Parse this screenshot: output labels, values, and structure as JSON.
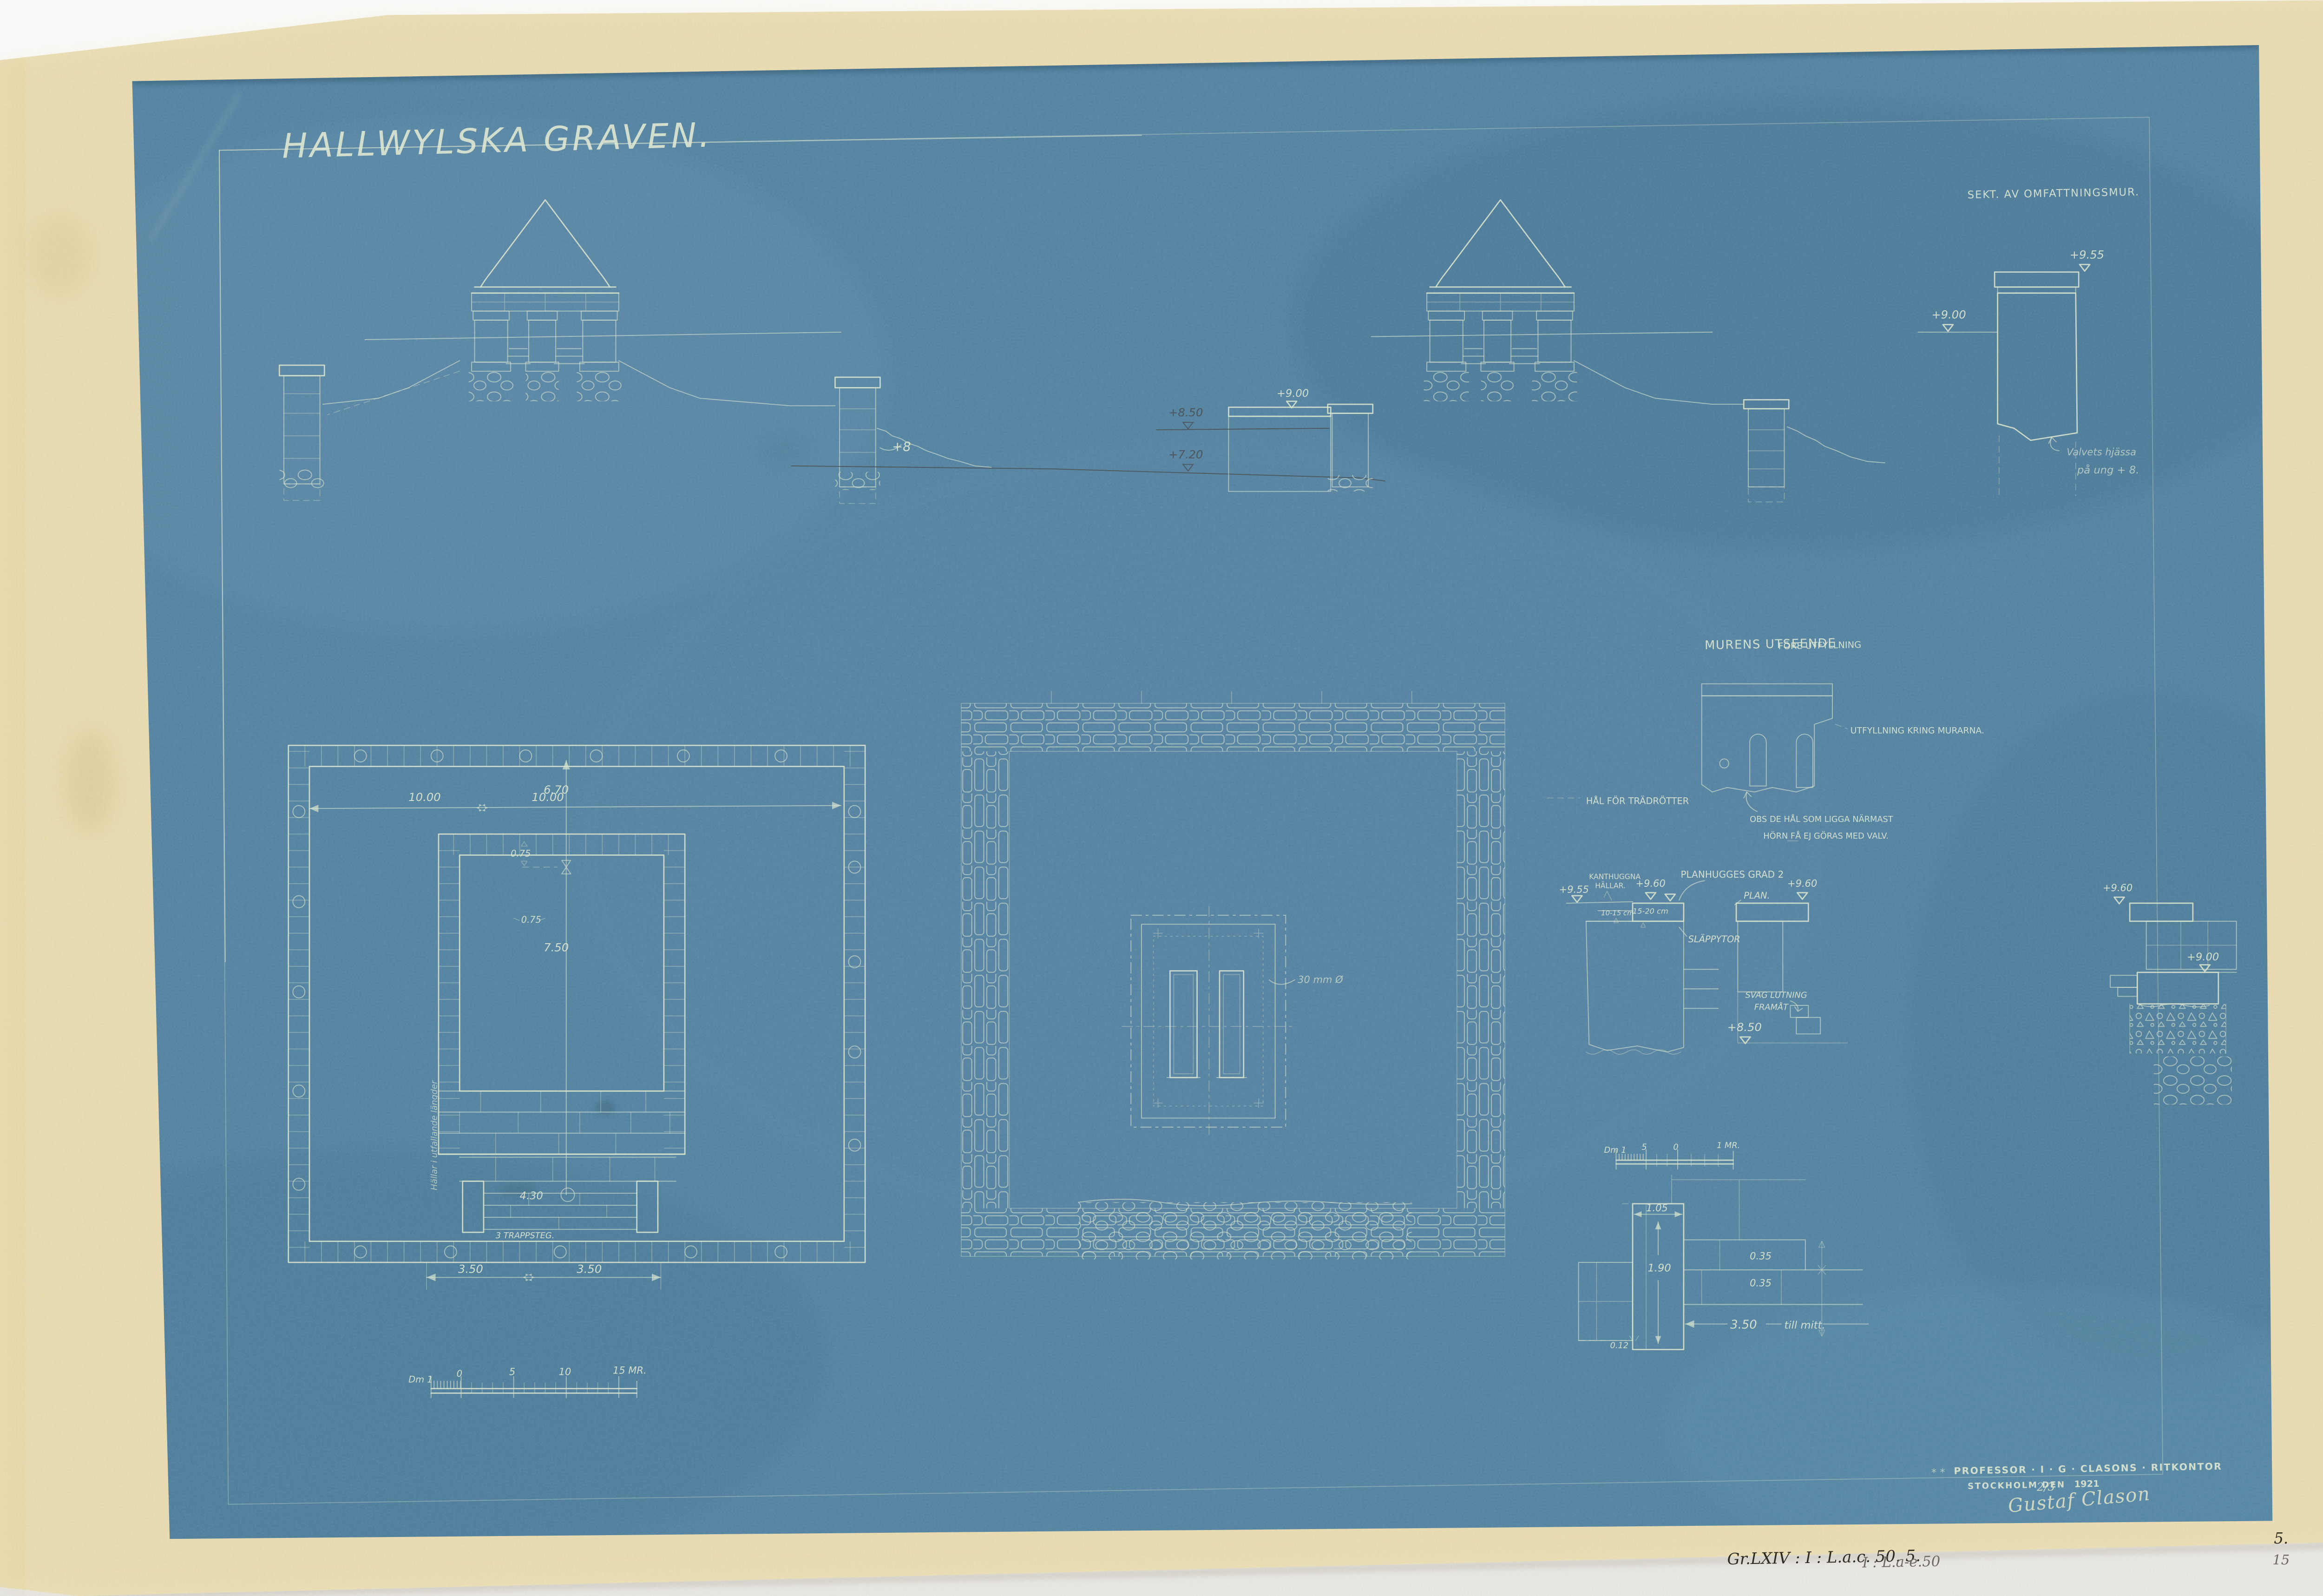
{
  "page": {
    "title": "HALLWYLSKA GRAVEN."
  },
  "margin": {
    "archive_ink": "Gr.LXIV : I : L.a.c. 50. 5.",
    "archive_pencil": "I : L.a-e.50",
    "sheet_ink": "5.",
    "sheet_pencil": "15",
    "stamp_marks": "* *"
  },
  "stamp": {
    "office": "PROFESSOR · I · G · CLASONS · RITKONTOR",
    "place": "STOCKHOLM DEN",
    "date": "2/3",
    "year": "1921",
    "signature": "Gustaf Clason"
  },
  "wall_section": {
    "title": "SEKT. AV OMFATTNINGSMUR.",
    "level_top": "+9.55",
    "level_mid": "+9.00",
    "note_line1": "Valvets hjässa",
    "note_line2": "på ung + 8."
  },
  "elevation_left": {
    "level_right": "+8"
  },
  "elevation_right": {
    "level_wall": "+9.00",
    "pencil_level_upper": "+8.50",
    "pencil_level_lower": "+7.20"
  },
  "plan_left": {
    "dim_width_a": "10.00",
    "dim_width_b": "10.00",
    "dim_a": "6.70",
    "dim_wall_a": "0.75",
    "dim_wall_b": "0.75",
    "dim_b": "7.50",
    "dim_c": "4.30",
    "steps_label": "3 TRAPPSTEG.",
    "dim_step_a": "3.50",
    "dim_step_b": "3.50",
    "wall_note": "Hällar i utfallande längder"
  },
  "plan_center": {
    "bore_note": "30 mm Ø"
  },
  "wall_study": {
    "title": "MURENS UTSEENDE",
    "subtitle": "FÖRE UTFYLLNING",
    "fill_label": "UTFYLLNING KRING MURARNA.",
    "holes_label": "HÅL FÖR TRÄDRÖTTER",
    "note_line1": "OBS DE HÅL SOM LIGGA NÄRMAST",
    "note_line2": "HÖRN FÅ EJ GÖRAS MED VALV."
  },
  "detail_slabs": {
    "level_a": "+9.55",
    "label_a1": "KANTHUGGNA",
    "label_a2": "HÄLLAR.",
    "level_b": "+9.60",
    "title": "PLANHUGGES GRAD 2",
    "dim_a": "10-15 cm",
    "dim_b": "15-20 cm",
    "face_label": "SLÄPPYTOR"
  },
  "detail_plan": {
    "label": "PLAN.",
    "level_top": "+9.60",
    "slope_line1": "SVAG LUTNING",
    "slope_line2": "FRAMÅT",
    "level_low": "+8.50"
  },
  "detail_corner": {
    "level_top": "+9.60",
    "level_mid": "+9.00"
  },
  "scale_main": {
    "l0": "Dm 1",
    "l1": "0",
    "l2": "5",
    "l3": "10",
    "l4": "15 MR."
  },
  "scale_detail": {
    "l0": "Dm 1",
    "l1": "5",
    "l2": "0",
    "l3": "1 MR."
  },
  "detail_kerb": {
    "dim_width": "1.05",
    "dim_height": "1.90",
    "dim_offset": "0.12",
    "dim_course_a": "0.35",
    "dim_course_b": "0.35",
    "dim_span": "3.50",
    "span_note": "till mitt."
  }
}
